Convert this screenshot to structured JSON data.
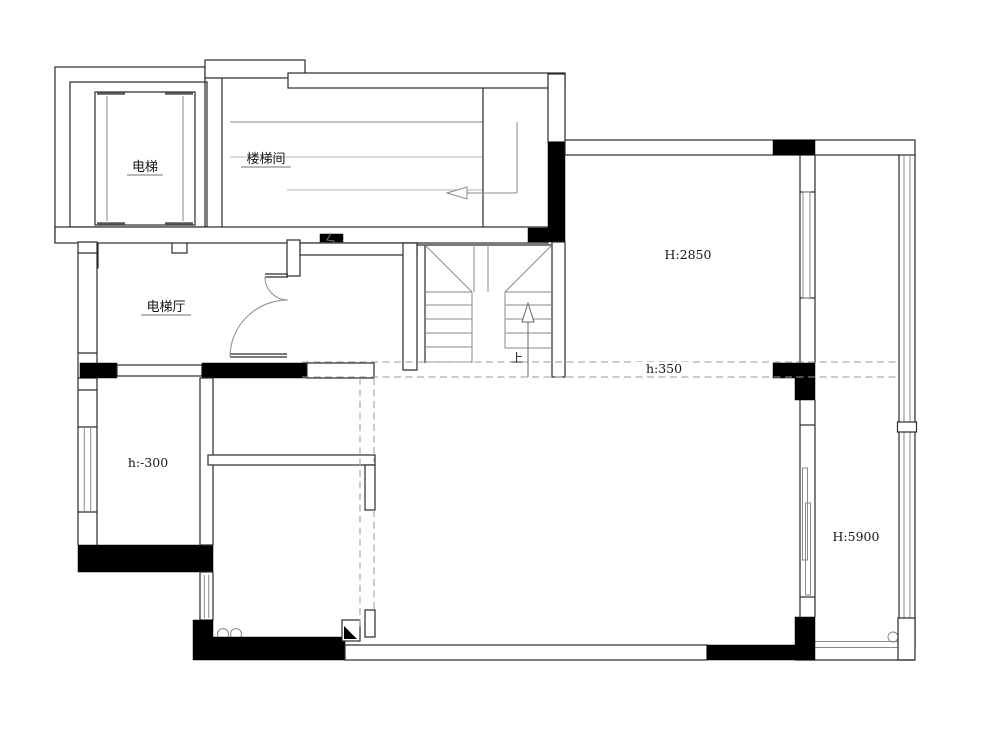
{
  "drawing": {
    "type": "residential floor plan",
    "background": "#ffffff",
    "line_color": "#2a2a2a",
    "detail_color": "#999999",
    "solid_wall_fill": "#000000"
  },
  "labels": {
    "elevator": "电梯",
    "stairwell": "楼梯间",
    "elevator_hall": "电梯厅",
    "right_room_height": "H:2850",
    "step_height": "h:350",
    "sunken_floor_height": "h:-300",
    "double_height": "H:5900",
    "stairs_up": "上"
  }
}
